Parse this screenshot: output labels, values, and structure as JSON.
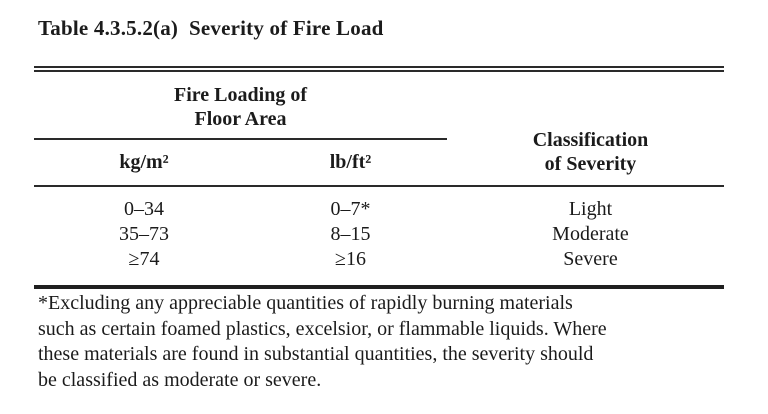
{
  "title": "Table 4.3.5.2(a)  Severity of Fire Load",
  "colors": {
    "background": "#ffffff",
    "text": "#1b1b1b",
    "rule": "#2a2a2a"
  },
  "table": {
    "spanner": {
      "line1": "Fire Loading of",
      "line2": "Floor Area"
    },
    "unit_headers": {
      "kg": "kg/m²",
      "lb": "lb/ft²"
    },
    "classification_header": {
      "line1": "Classification",
      "line2": "of Severity"
    },
    "rows": [
      {
        "kg": "0–34",
        "lb": "0–7*",
        "classification": "Light"
      },
      {
        "kg": "35–73",
        "lb": "8–15",
        "classification": "Moderate"
      },
      {
        "kg": "≥74",
        "lb": "≥16",
        "classification": "Severe"
      }
    ]
  },
  "footnote": {
    "lines": [
      "*Excluding any appreciable quantities of rapidly burning materials",
      "such as certain foamed plastics, excelsior, or flammable liquids. Where",
      "these materials are found in substantial quantities, the severity should",
      "be classified as moderate or severe."
    ]
  }
}
